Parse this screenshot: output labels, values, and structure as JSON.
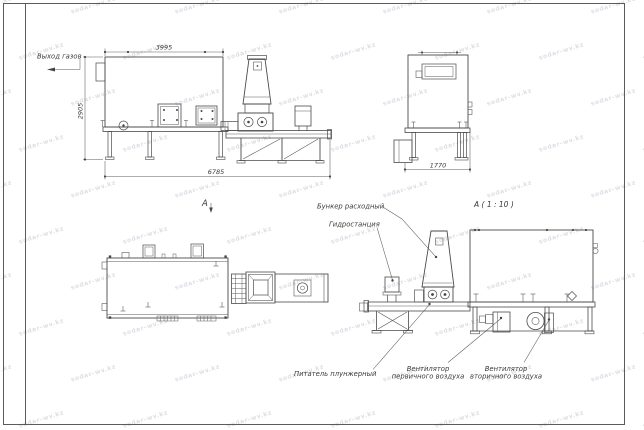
{
  "watermark": {
    "text": "sodar-wv.kz",
    "color": "#d9dce2"
  },
  "labels": {
    "gas_outlet": "Выход газов",
    "view_a": "A",
    "section_title": "A ( 1 : 10 )",
    "hopper": "Бункер расходный",
    "hydro": "Гидростанция",
    "feeder": "Питатель плунжерный",
    "fan_primary": {
      "line1": "Вентилятор",
      "line2": "первичного воздуха"
    },
    "fan_secondary": {
      "line1": "Вентилятор",
      "line2": "вторичного воздуха"
    }
  },
  "dimensions": {
    "top": "3995",
    "left": "2905",
    "bottom": "6785",
    "front_width": "1770"
  }
}
